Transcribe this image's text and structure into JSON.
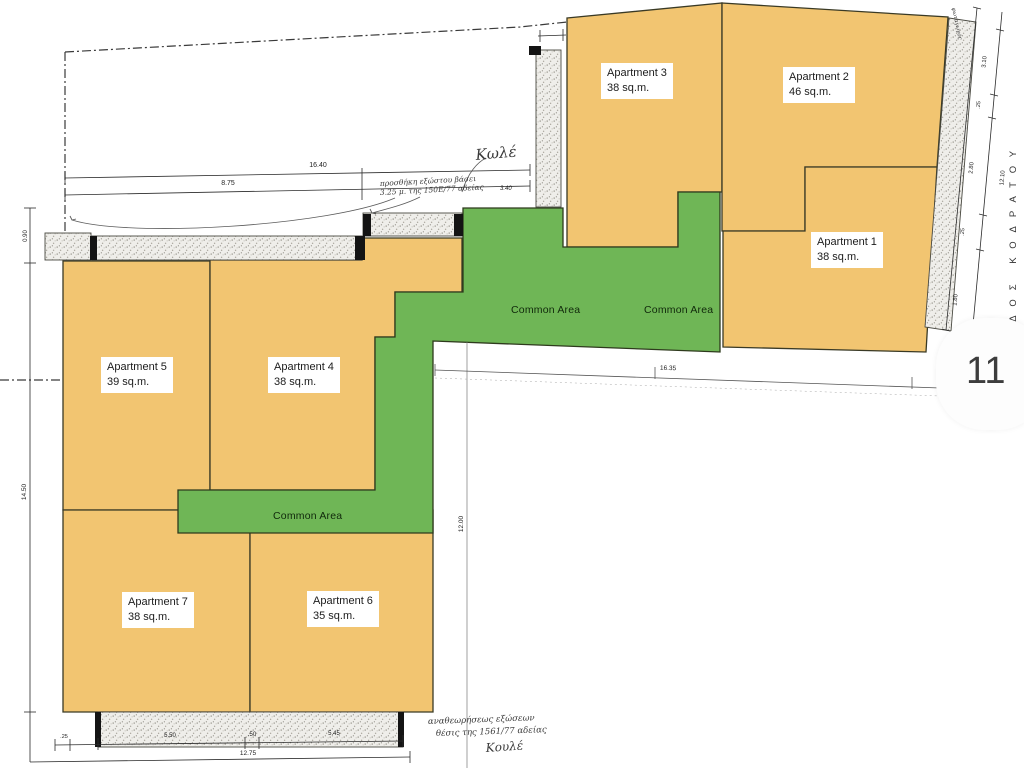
{
  "badge": {
    "count": "11"
  },
  "apartments": [
    {
      "name": "Apartment 1",
      "area": "38 sq.m."
    },
    {
      "name": "Apartment 2",
      "area": "46 sq.m."
    },
    {
      "name": "Apartment 3",
      "area": "38 sq.m."
    },
    {
      "name": "Apartment 4",
      "area": "38 sq.m."
    },
    {
      "name": "Apartment 5",
      "area": "39 sq.m."
    },
    {
      "name": "Apartment 6",
      "area": "35 sq.m."
    },
    {
      "name": "Apartment 7",
      "area": "38 sq.m."
    }
  ],
  "common_area_labels": [
    "Common Area",
    "Common Area",
    "Common Area"
  ],
  "street": {
    "name": "ΟΔΟΣ ΚΟΔΡΑΤΟΥ"
  },
  "dimensions": {
    "top_total": "16.40",
    "top_left": "8.75",
    "terrace_gap": "1.00",
    "left_upper": "0.90",
    "left_total": "14.50",
    "middle_width": "16.35",
    "middle_height": "12.00",
    "right_seg_1": "3.10",
    "right_seg_2": ".25",
    "right_seg_3": "2.80",
    "right_seg_4": ".25",
    "right_seg_5": "1.80",
    "right_total": "12.10",
    "bottom_seg_0": ".25",
    "bottom_seg_1": "5.50",
    "bottom_seg_2": ".50",
    "bottom_seg_3": "5.45",
    "bottom_total": "12.75",
    "note_small": "3.40"
  },
  "annotations": {
    "sig_top": "Κωλέ",
    "note_top_line1": "προσθήκη εξώστου βάσει",
    "note_top_line2": "3.25 μ. της 150Ε/77 αδείας",
    "note_bottom_line1": "αναθεωρήσεως εξώσεων",
    "note_bottom_line2": "θέσις της 1561/77 αδείας",
    "sig_bottom": "Κουλέ",
    "corner_note": "φωταγωγός"
  },
  "colors": {
    "apartment_fill": "#F2C571",
    "common_fill": "#6FB656",
    "outline": "#3A3A2A"
  }
}
